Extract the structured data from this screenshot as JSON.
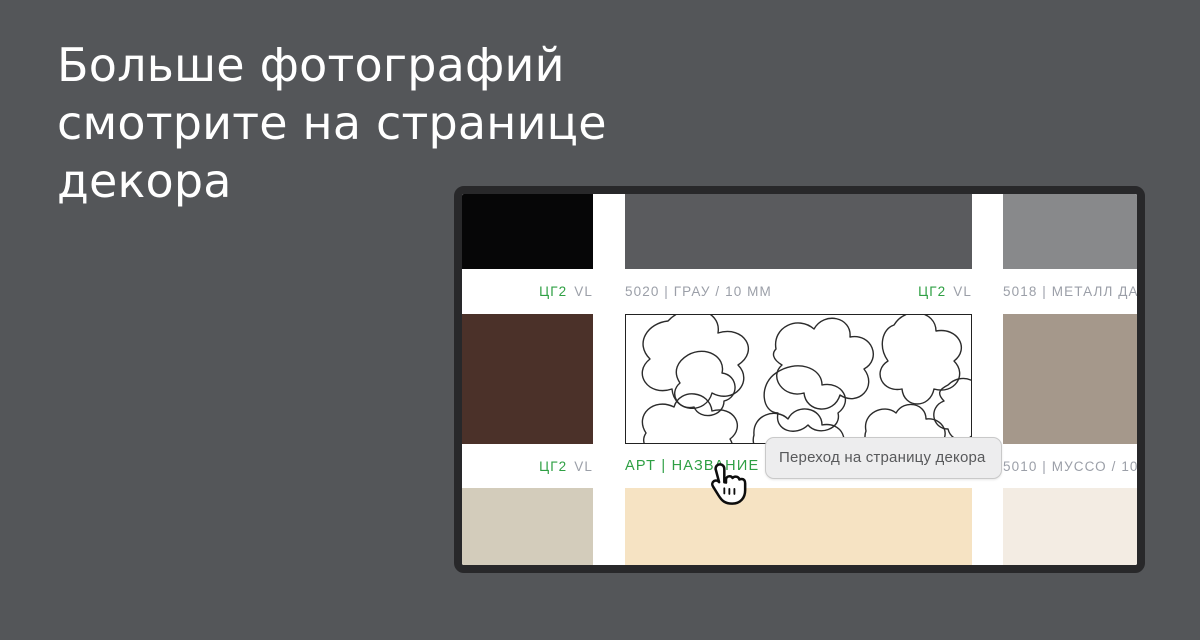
{
  "headline": {
    "lines": [
      "Больше фотографий",
      "смотрите на странице",
      "декора"
    ]
  },
  "colors": {
    "page_background": "#545659",
    "frame": "#28282a",
    "accent_green": "#2fa044",
    "label_gray": "#9b9fa8",
    "tooltip_background": "#ededee",
    "tooltip_text": "#58595b"
  },
  "grid": {
    "code_green": "ЦГ2",
    "code_gray": "VL",
    "row1": {
      "left": {
        "color": "#060607"
      },
      "center": {
        "color": "#5a5b5e",
        "article": "5020 | ГРАУ / 10 ММ"
      },
      "right": {
        "color": "#88898b",
        "article": "5018 | МЕТАЛЛ ДАР"
      }
    },
    "row2": {
      "left": {
        "color": "#4b3129"
      },
      "center": {
        "link_label": "АРТ | НАЗВАНИЕ"
      },
      "right": {
        "color": "#a5988b",
        "article": "5010 | МУССО / 10 М"
      }
    },
    "row3": {
      "left": {
        "color": "#d3ccbb"
      },
      "center": {
        "color": "#f6e3c3"
      },
      "right": {
        "color": "#f3ece3"
      }
    }
  },
  "tooltip": {
    "text": "Переход на страницу декора"
  },
  "icons": {
    "cursor": "hand-pointer-cursor",
    "pattern": "abstract-line-art-decor"
  }
}
